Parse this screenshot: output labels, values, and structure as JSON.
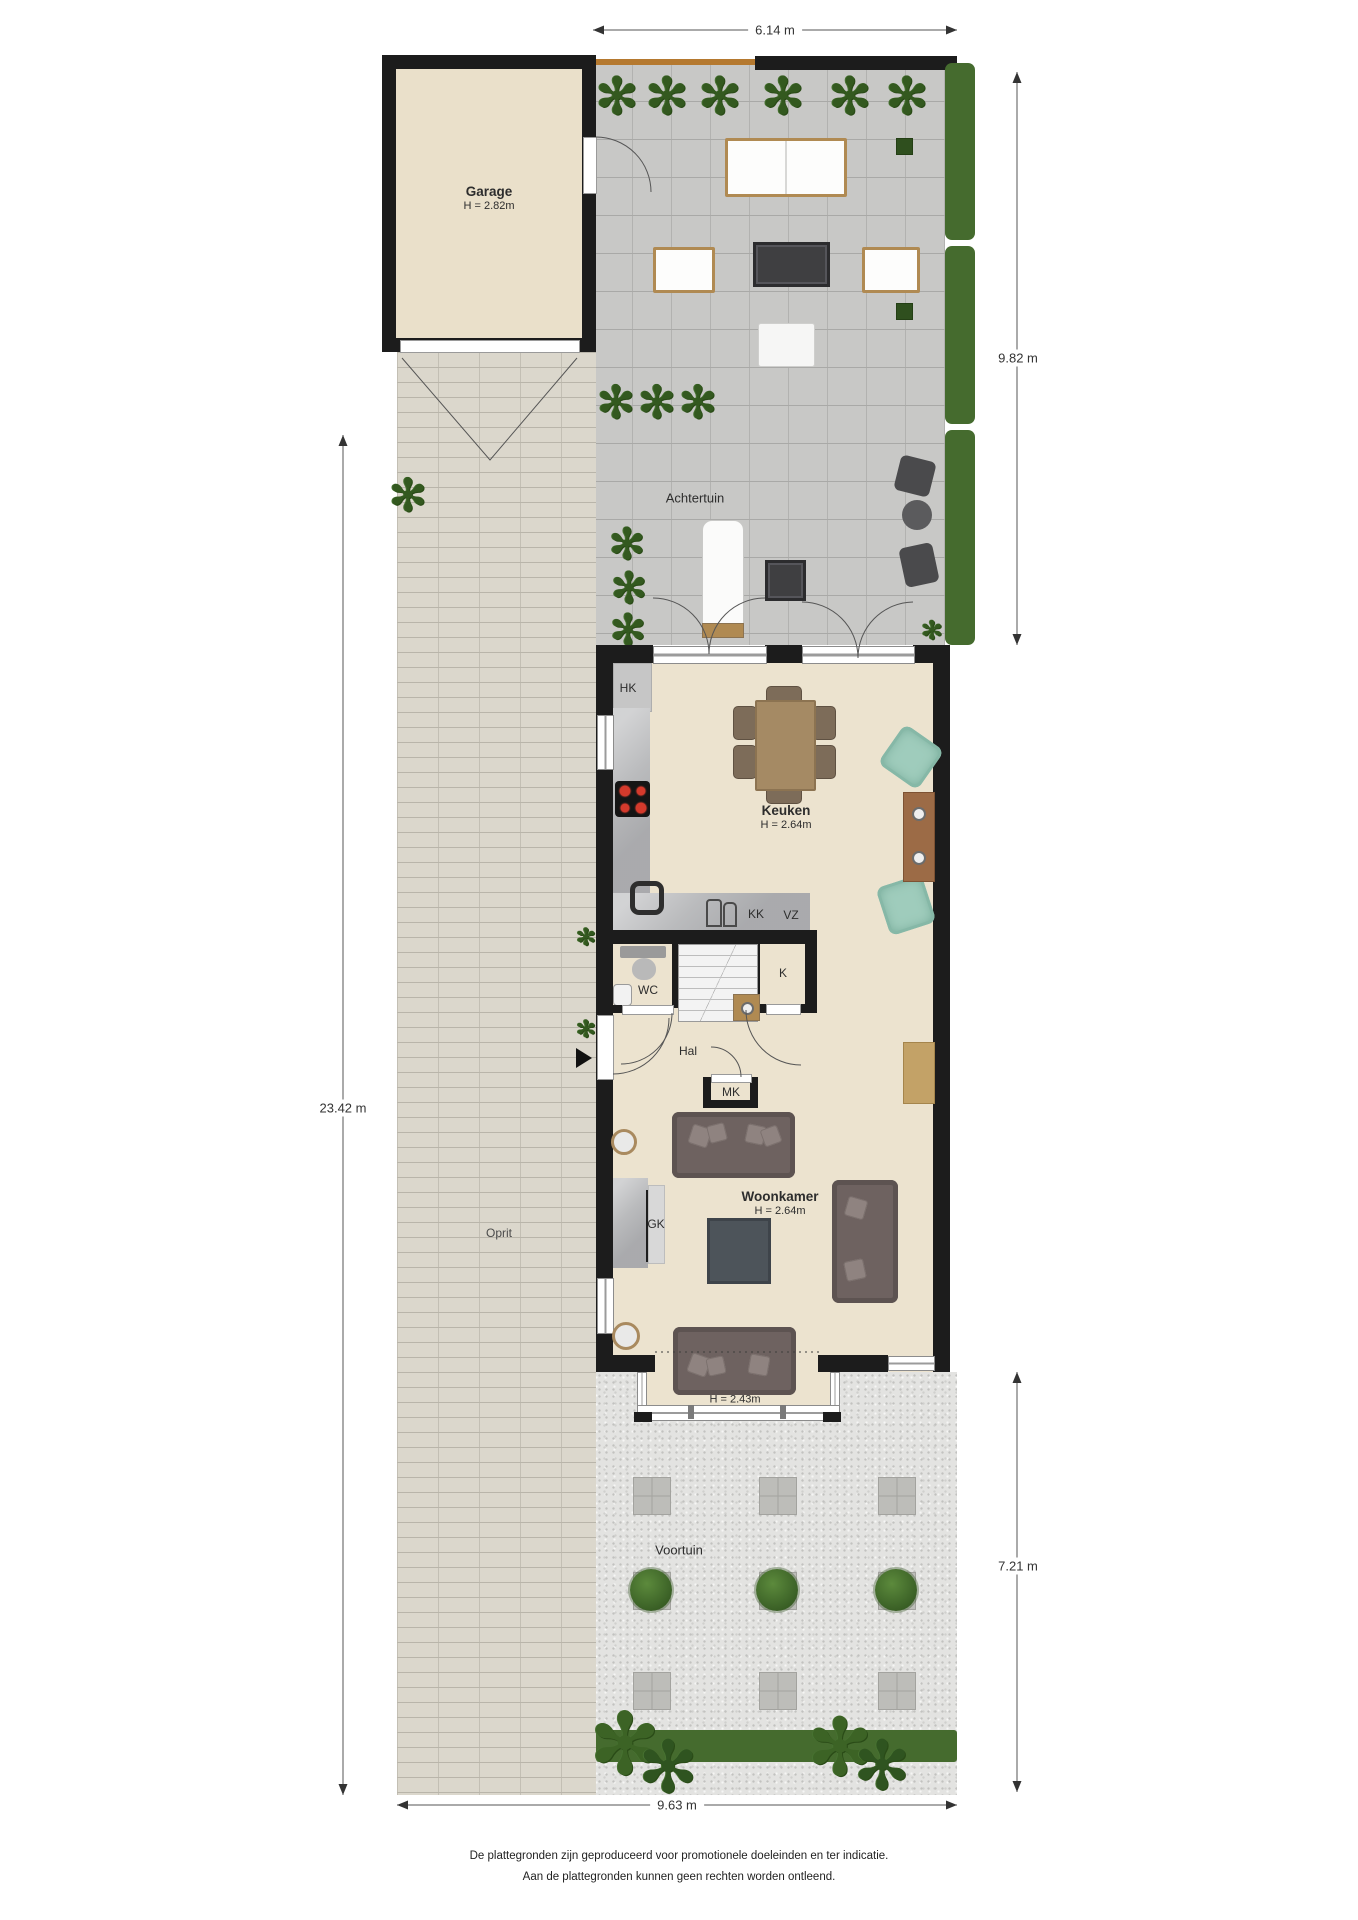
{
  "dimensions": {
    "top": "6.14 m",
    "garden_depth": "9.82 m",
    "plot_depth": "23.42 m",
    "front_depth": "7.21 m",
    "bottom_width": "9.63 m"
  },
  "rooms": {
    "garage": {
      "label": "Garage",
      "height": "H = 2.82m"
    },
    "achtertuin": {
      "label": "Achtertuin"
    },
    "keuken": {
      "label": "Keuken",
      "height": "H = 2.64m"
    },
    "woonkamer": {
      "label": "Woonkamer",
      "height": "H = 2.64m"
    },
    "erker": {
      "height": "H = 2.43m"
    },
    "hal": {
      "label": "Hal"
    },
    "wc": {
      "label": "WC"
    },
    "oprit": {
      "label": "Oprit"
    },
    "voortuin": {
      "label": "Voortuin"
    }
  },
  "closets": {
    "hk": "HK",
    "kk": "KK",
    "vz": "VZ",
    "k": "K",
    "mk": "MK",
    "gk": "GK"
  },
  "icons": {
    "plant_glyph": "✻"
  },
  "footer": {
    "line1": "De plattegronden zijn geproduceerd voor promotionele doeleinden en ter indicatie.",
    "line2": "Aan de plattegronden kunnen geen rechten worden ontleend."
  },
  "colors": {
    "wall": "#1c1c1c",
    "floor": "#ece3cf",
    "garage_floor": "#eae0ca",
    "patio_tile": "#c8c8c6",
    "brick": "#dbd7cc",
    "gravel": "#e3e3e1",
    "hedge": "#456b2e",
    "plant": "#33591f",
    "wood": "#a98a5f",
    "sofa": "#6e6260",
    "teal_chair": "#9fccbc",
    "marble": "#babbbd",
    "dark_table": "#3f3f41",
    "fence": "#b5792f",
    "dimension": "#444444"
  }
}
